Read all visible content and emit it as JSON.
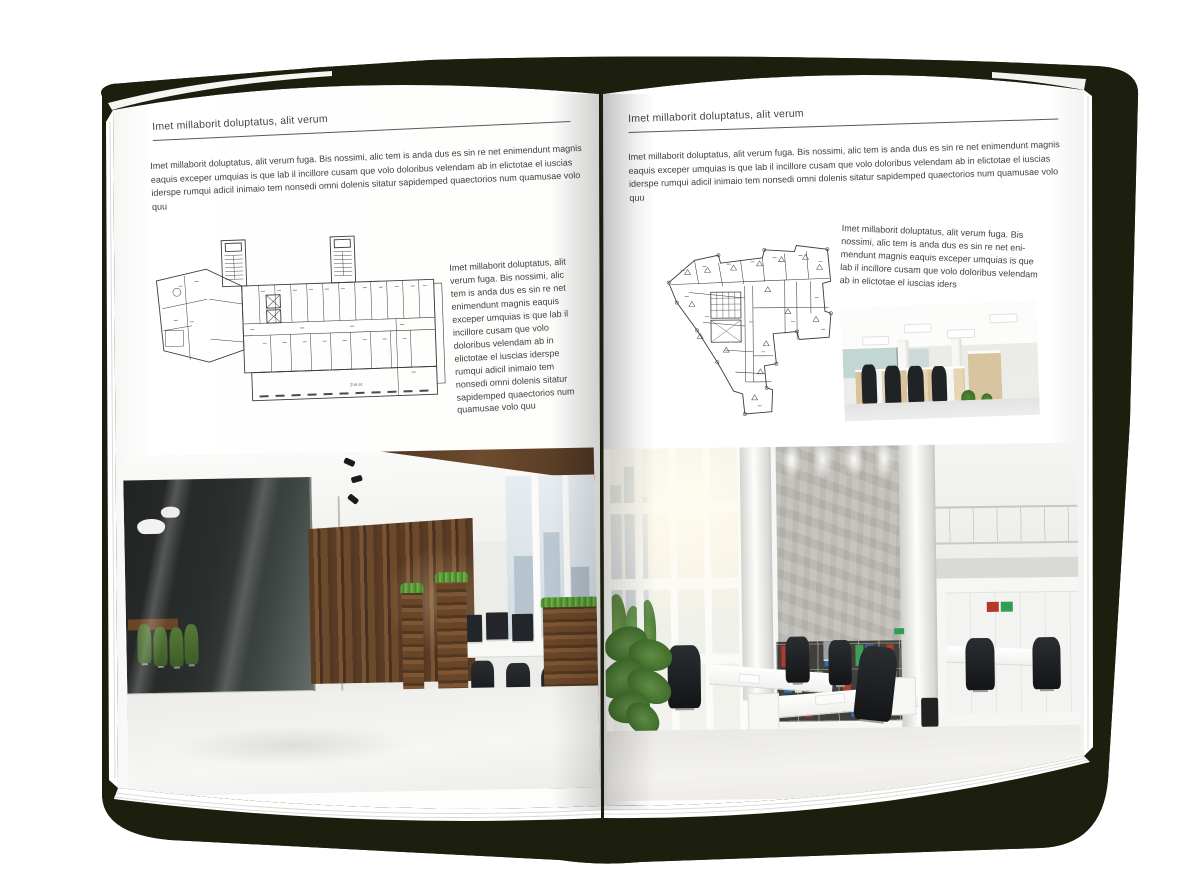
{
  "colors": {
    "backdrop_shadow": "#1d1f0e",
    "page": "#ffffff",
    "text": "#3f3f3f",
    "rule": "#5a5a5a",
    "plan_line": "#3c3c3c",
    "binder_red": "#b23b2e",
    "binder_green": "#3f9e57",
    "binder_blue": "#2e6fb0",
    "wood_accent": "#6b4527",
    "meeting_chair_green": "#50722f"
  },
  "left_page": {
    "header": "Imet millaborit doluptatus, alit verum",
    "intro": "Imet millaborit doluptatus, alit verum fuga. Bis nossimi, alic tem is anda dus es sin re net enimendunt magnis eaquis exceper umquias is que lab il incillore cusam que volo doloribus velendam ab in elictotae el iuscias iderspe rumqui adicil inimaio tem nonsedi omni dolenis sitatur sapidemped quaectorios num quamusae volo quu",
    "plan_label": "2-й эт.",
    "side_text": "Imet millaborit doluptatus, alit verum fuga. Bis nossimi, alic tem is anda dus es sin re net enimendunt magnis eaquis exceper umquias is que lab il incillore cusam que volo doloribus velendam ab in elictotae el iuscias iderspe rumqui adicil inimaio tem nonsedi omni dolenis sitatur sapidemped quaectorios num quamusae volo quu"
  },
  "right_page": {
    "header": "Imet millaborit doluptatus, alit verum",
    "intro": "Imet millaborit doluptatus, alit verum fuga. Bis nossimi, alic tem is anda dus es sin re net enimendunt magnis eaquis exceper umquias is que lab il incillore cusam que volo doloribus velendam ab in elictotae el iuscias iderspe rumqui adicil inimaio tem nonsedi omni dolenis sitatur sapidemped quaectorios num quamusae volo quu",
    "side_text": "Imet millaborit doluptatus, alit verum fuga. Bis nossimi, alic tem is anda dus es sin re net eni-mendunt magnis eaquis exceper umquias is que lab il incillore cusam que volo doloribus velendam ab in elictotae el iuscias iders"
  }
}
